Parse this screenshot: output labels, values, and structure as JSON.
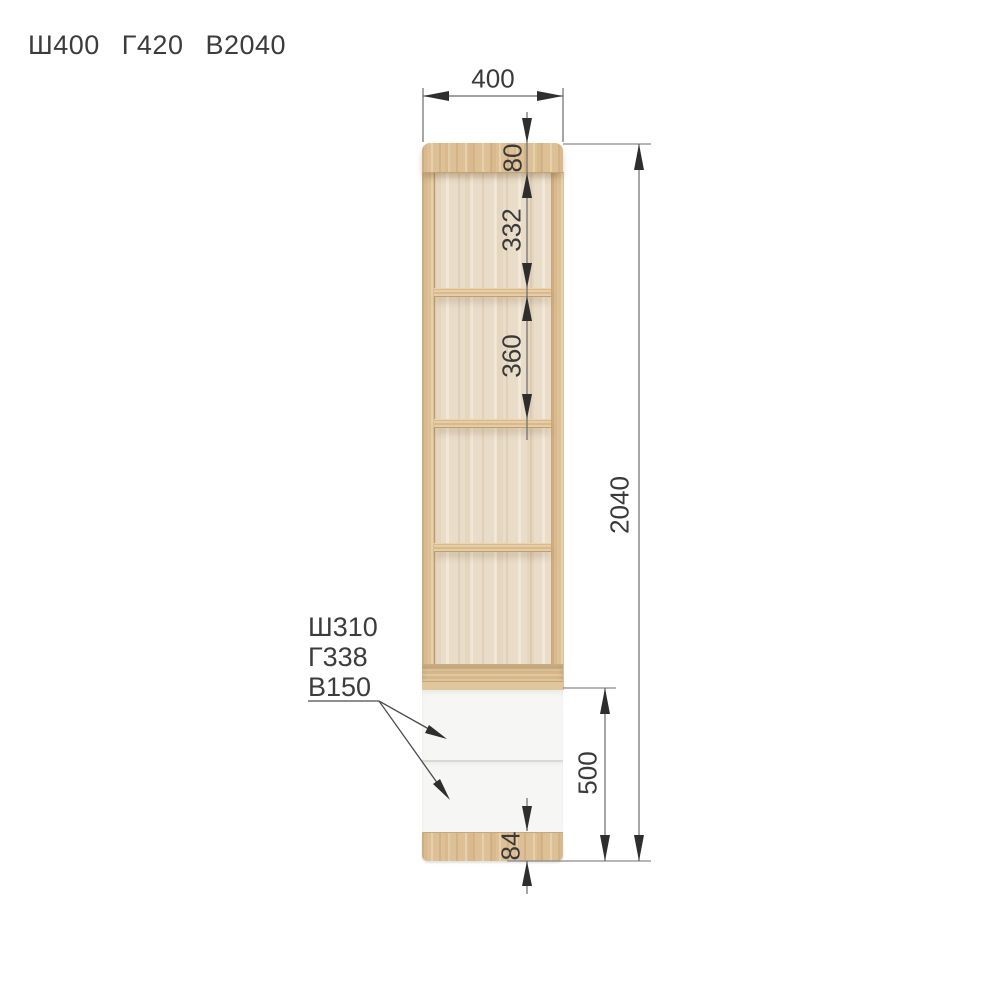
{
  "title": {
    "width": "Ш400",
    "depth": "Г420",
    "height": "В2040"
  },
  "dimensions": {
    "overall_width": "400",
    "top_panel_offset": "80",
    "compartment_1_height": "332",
    "compartment_2_height": "360",
    "overall_height": "2040",
    "drawer_unit_height": "500",
    "plinth_height": "84"
  },
  "drawer_callout": {
    "width": "Ш310",
    "depth": "Г338",
    "height": "В150"
  },
  "colors": {
    "wood": "#ddc096",
    "interior_back": "#e9dcc8",
    "drawer_front": "#f6f6f4",
    "handle_accent": "#f6921e",
    "dimension_line": "#6a6a6a",
    "arrow": "#2e2e2e",
    "text": "#3a3a3a"
  }
}
